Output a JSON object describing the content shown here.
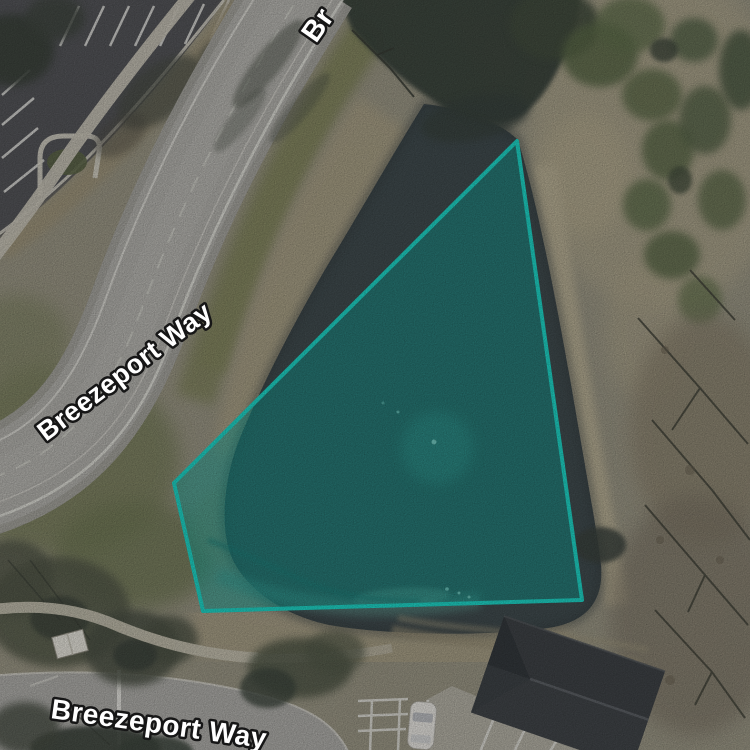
{
  "canvas": {
    "width": 750,
    "height": 750
  },
  "map": {
    "imagery": "aerial-satellite",
    "street_labels": [
      {
        "id": "breezeport-way-top-partial",
        "text": "Br"
      },
      {
        "id": "breezeport-way-middle",
        "text": "Breezeport Way"
      },
      {
        "id": "breezeport-way-bottom",
        "text": "Breezeport Way"
      }
    ],
    "selection": {
      "shape": "polygon",
      "feature": "pond-parcel",
      "points": "517,141 582,600 203,611 174,483",
      "stroke_color": "#1fd8ca",
      "fill_color": "rgba(13,168,158,0.5)"
    }
  }
}
